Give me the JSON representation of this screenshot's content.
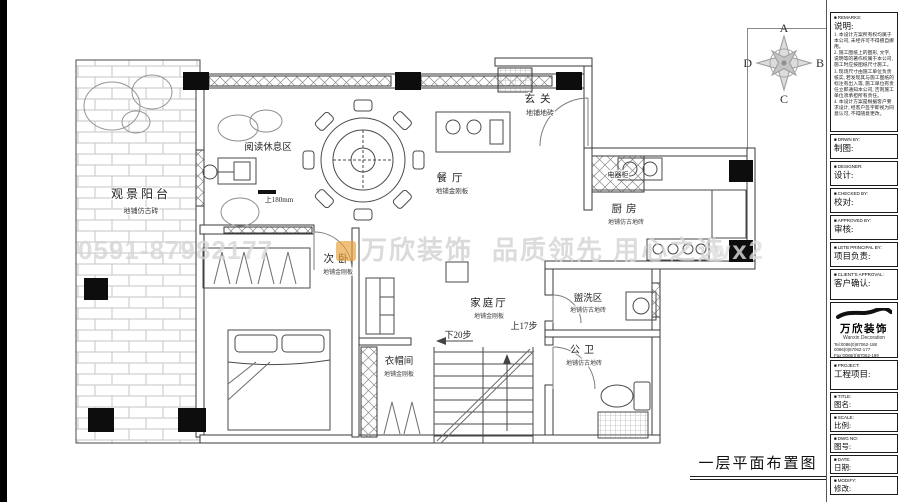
{
  "sheet": {
    "drawing_title": "一层平面布置图",
    "compass": {
      "top": "A",
      "right": "B",
      "bottom": "C",
      "left": "D"
    }
  },
  "plan": {
    "rooms": [
      {
        "name": "观景阳台",
        "finish": "地铺仿古砖"
      },
      {
        "name": "阅读休息区",
        "finish": ""
      },
      {
        "name": "玄关",
        "finish": "地铺地砖"
      },
      {
        "name": "餐厅",
        "finish": "地铺金刚板"
      },
      {
        "name": "电器柜",
        "finish": ""
      },
      {
        "name": "厨房",
        "finish": "地铺仿古地砖"
      },
      {
        "name": "次卧",
        "finish": "地铺金刚板"
      },
      {
        "name": "家庭厅",
        "finish": "地铺金刚板"
      },
      {
        "name": "盥洗区",
        "finish": "地铺仿古地砖"
      },
      {
        "name": "公卫",
        "finish": "地铺仿古地砖"
      },
      {
        "name": "衣帽间",
        "finish": "地铺金刚板"
      }
    ],
    "annotations": {
      "entry_step": "上180mm",
      "stairs_down": "下20步",
      "stairs_up": "上17步"
    }
  },
  "titleblock": {
    "remarks": {
      "tag": "REMARKS:",
      "label": "说明:",
      "notes": [
        "1. 本设计方案所有权均属于本公司, 未经许可不得擅自挪用。",
        "2. 施工图纸上的图形, 文字, 说明等的著作权属于本公司, 施工时应按图纸尺寸施工。",
        "3. 现场尺寸由施工单位负责核实, 若发现其与施工图纸的标注有出入等, 施工单位有责任立即通知本公司, 否则施工单位须承担所有责任。",
        "4. 本设计方案是根据客户要求设计, 经客户签字即视为同意认可, 不得随意更改。"
      ]
    },
    "fields": [
      {
        "tag": "DRWN BY:",
        "label": "制图:"
      },
      {
        "tag": "DESIGNER:",
        "label": "设计:"
      },
      {
        "tag": "CHECKED BY:",
        "label": "校对:"
      },
      {
        "tag": "APPROVED BY:",
        "label": "审核:"
      },
      {
        "tag": "LETB PRINCIPAL BY:",
        "label": "项目负责:"
      },
      {
        "tag": "CLIENT'S APPROVAL:",
        "label": "客户确认:"
      }
    ],
    "company": {
      "name": "万欣装饰",
      "name_en": "Wanxin Decoration",
      "tel1": "Tel:0086(0)87062-188",
      "tel2": "0086(0)87062-177",
      "fax": "Fax:0086(0)87062-199",
      "web": "Web:WWW.fanxin.com"
    },
    "fields2": [
      {
        "tag": "PROJECT:",
        "label": "工程项目:"
      },
      {
        "tag": "TITLE:",
        "label": "图名:"
      },
      {
        "tag": "SCALE:",
        "label": "比例:"
      },
      {
        "tag": "DWG NO:",
        "label": "图号:"
      },
      {
        "tag": "DATE:",
        "label": "日期:"
      },
      {
        "tag": "MODIFY:",
        "label": "修改:"
      }
    ]
  },
  "watermark": {
    "phone": "0591-87982177",
    "brand": "万欣装饰",
    "slogan": "品质领先 用心之选",
    "fragment": "wx2"
  }
}
